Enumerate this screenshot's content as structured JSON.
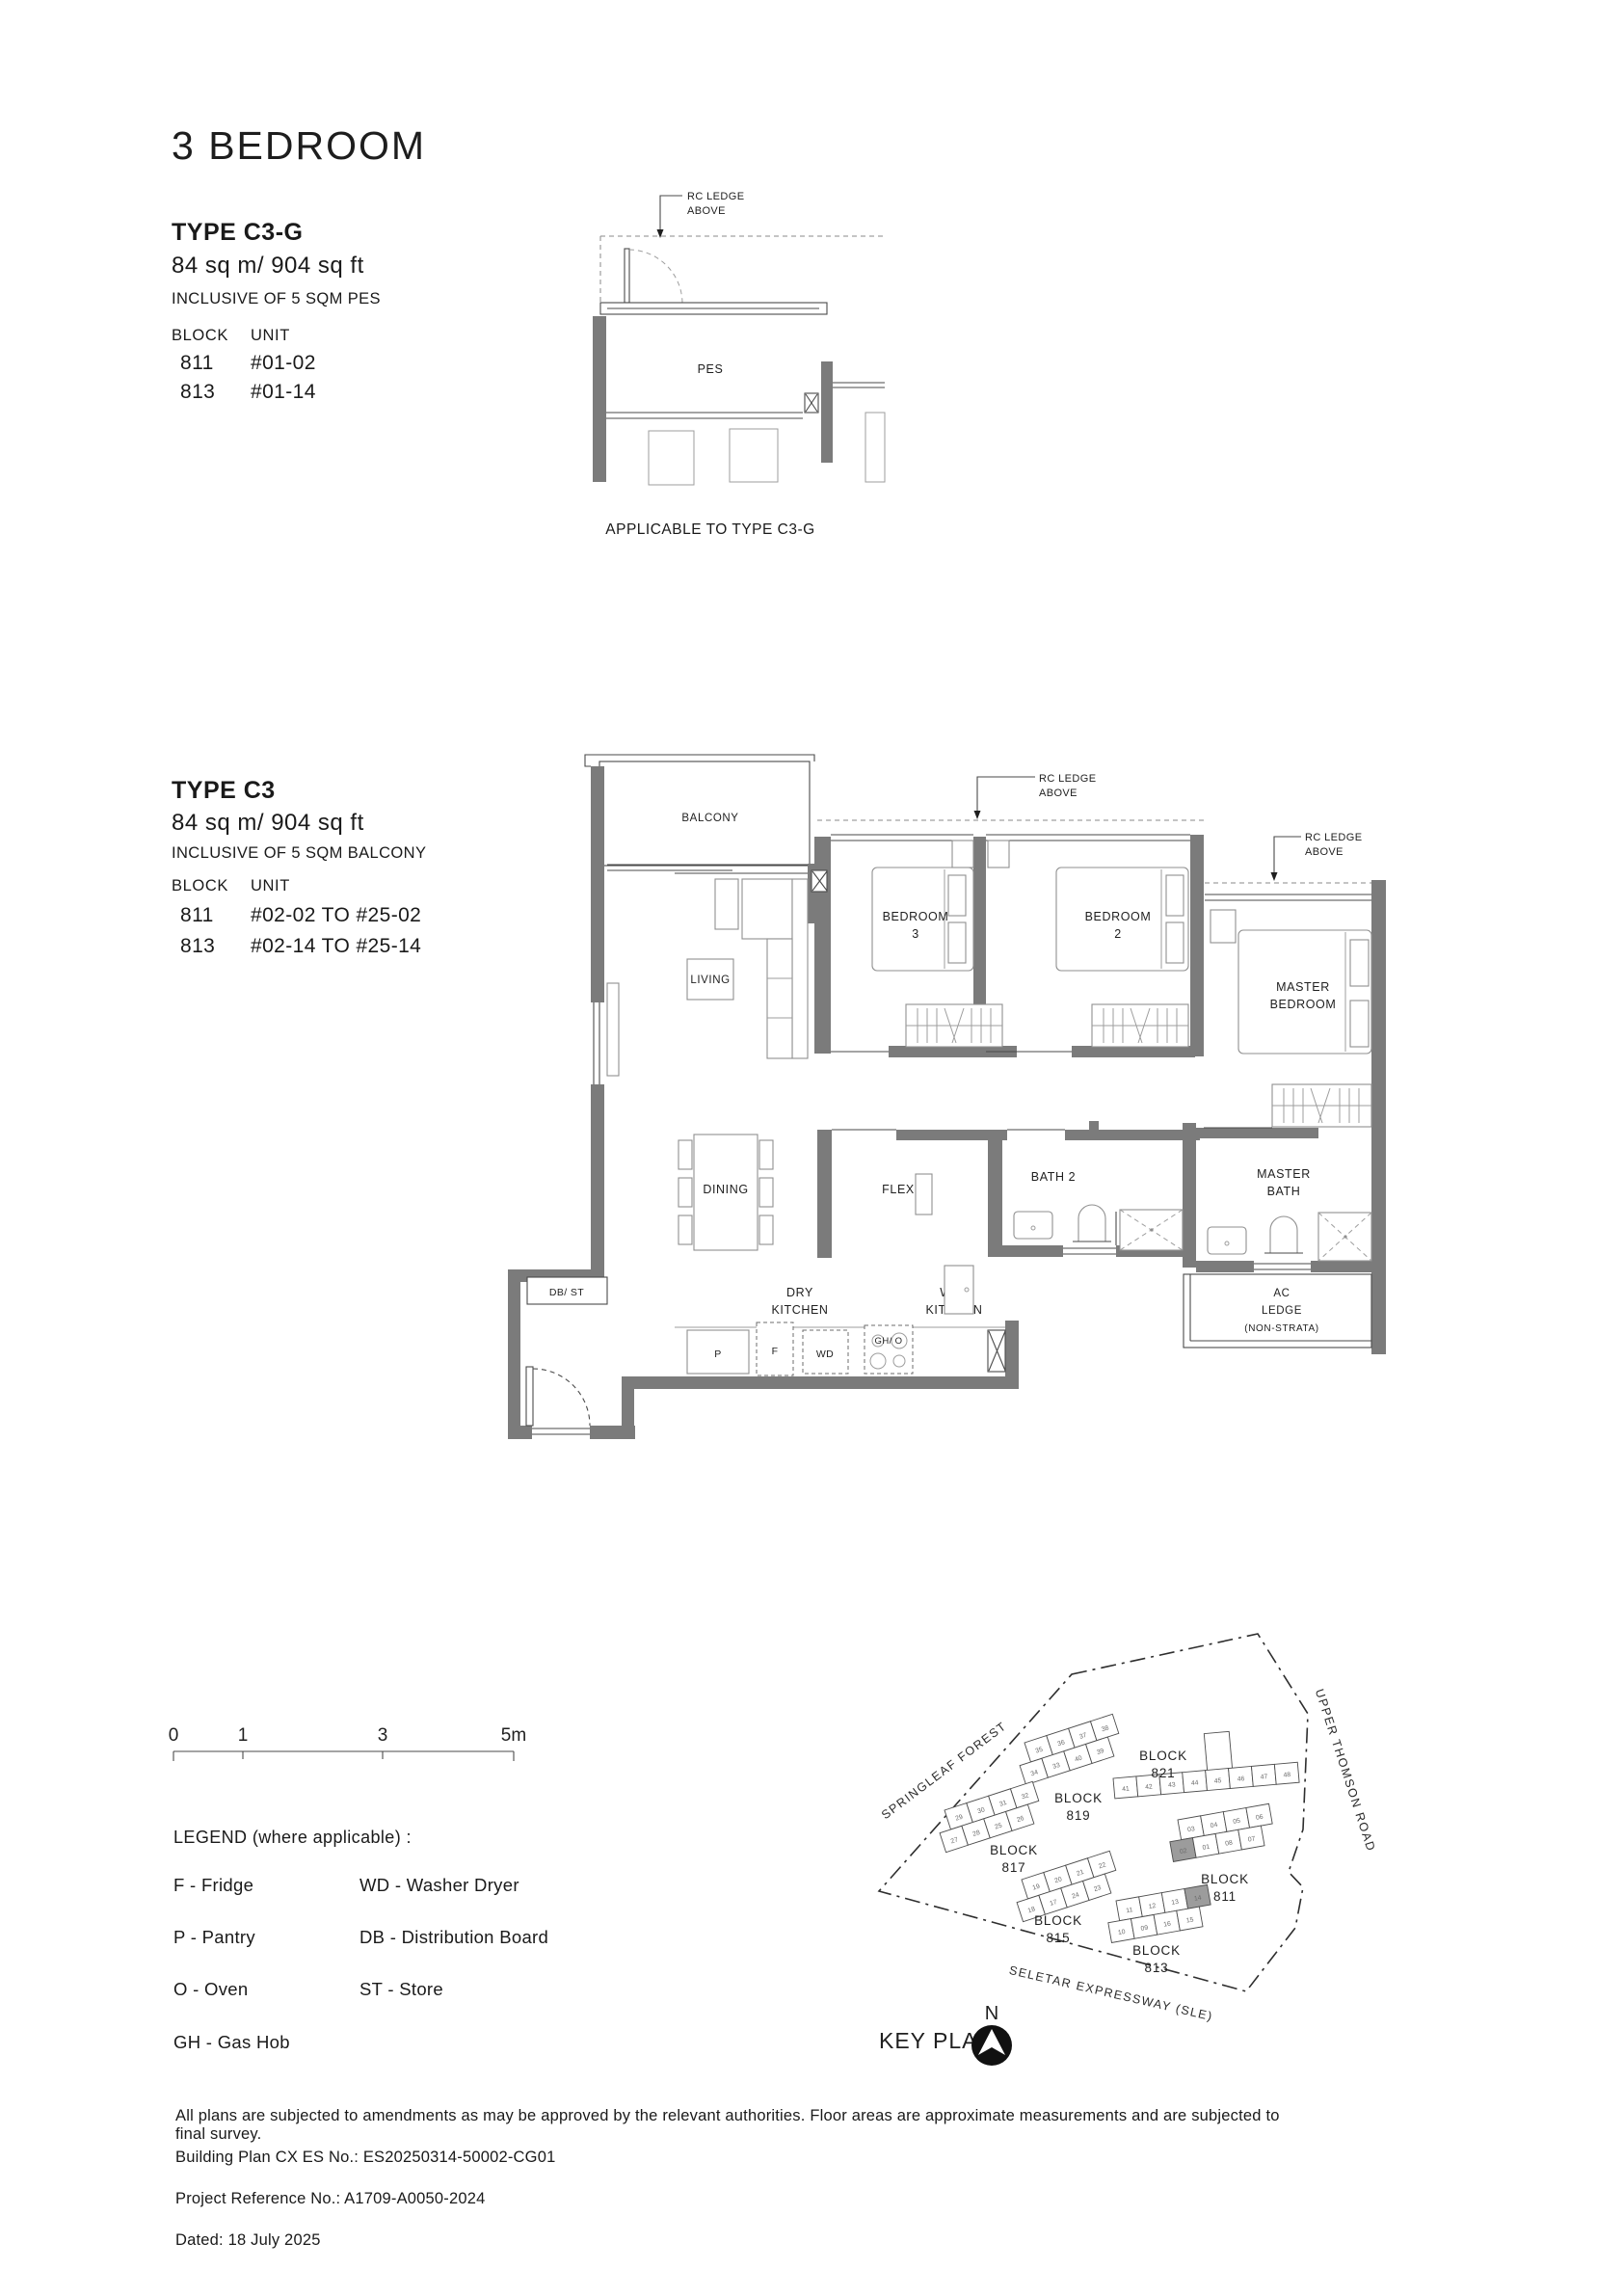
{
  "page_title": "3 BEDROOM",
  "type_c3g": {
    "name": "TYPE C3-G",
    "area": "84 sq m/ 904 sq ft",
    "inclusive": "INCLUSIVE OF 5 SQM PES",
    "block_header": "BLOCK",
    "unit_header": "UNIT",
    "rows": [
      {
        "block": "811",
        "unit": "#01-02"
      },
      {
        "block": "813",
        "unit": "#01-14"
      }
    ],
    "caption": "APPLICABLE TO TYPE C3-G"
  },
  "type_c3": {
    "name": "TYPE C3",
    "area": "84 sq m/ 904 sq ft",
    "inclusive": "INCLUSIVE OF 5 SQM BALCONY",
    "block_header": "BLOCK",
    "unit_header": "UNIT",
    "rows": [
      {
        "block": "811",
        "unit": "#02-02 TO #25-02"
      },
      {
        "block": "813",
        "unit": "#02-14 TO #25-14"
      }
    ]
  },
  "plan": {
    "rc_ledge_1": "RC LEDGE",
    "rc_ledge_2": "ABOVE",
    "pes": "PES",
    "balcony": "BALCONY",
    "living": "LIVING",
    "bedroom3_1": "BEDROOM",
    "bedroom3_2": "3",
    "bedroom2_1": "BEDROOM",
    "bedroom2_2": "2",
    "master_1": "MASTER",
    "master_2": "BEDROOM",
    "dining": "DINING",
    "flex": "FLEX",
    "bath2": "BATH 2",
    "masterbath_1": "MASTER",
    "masterbath_2": "BATH",
    "dry_1": "DRY",
    "dry_2": "KITCHEN",
    "wet_1": "WET",
    "wet_2": "KITCHEN",
    "db_st": "DB/ ST",
    "p": "P",
    "f": "F",
    "wd": "WD",
    "gho": "GH/ O",
    "ac_1": "AC",
    "ac_2": "LEDGE",
    "ac_3": "(NON-STRATA)"
  },
  "scale": {
    "t0": "0",
    "t1": "1",
    "t3": "3",
    "t5": "5m"
  },
  "legend": {
    "heading": "LEGEND (where applicable) :",
    "col1": [
      "F - Fridge",
      "P - Pantry",
      "O - Oven",
      "GH - Gas Hob"
    ],
    "col2": [
      "WD - Washer Dryer",
      "DB - Distribution Board",
      "ST - Store"
    ]
  },
  "keyplan": {
    "label": "KEY PLAN",
    "north": "N",
    "roads": {
      "left": "SPRINGLEAF FOREST",
      "right": "UPPER THOMSON ROAD",
      "bottom": "SELETAR EXPRESSWAY (SLE)"
    },
    "blocks": {
      "b819": {
        "l1": "BLOCK",
        "l2": "819",
        "top": [
          "35",
          "36",
          "37",
          "38"
        ],
        "bottom": [
          "34",
          "33",
          "40",
          "39"
        ]
      },
      "b821": {
        "l1": "BLOCK",
        "l2": "821",
        "row": [
          "41",
          "42",
          "43",
          "44",
          "45",
          "46",
          "47",
          "48"
        ]
      },
      "b817": {
        "l1": "BLOCK",
        "l2": "817",
        "top": [
          "29",
          "30",
          "31",
          "32"
        ],
        "bottom": [
          "27",
          "28",
          "25",
          "26"
        ]
      },
      "b815": {
        "l1": "BLOCK",
        "l2": "815",
        "top": [
          "19",
          "20",
          "21",
          "22"
        ],
        "bottom": [
          "18",
          "17",
          "24",
          "23"
        ]
      },
      "b811": {
        "l1": "BLOCK",
        "l2": "811",
        "top": [
          "03",
          "04",
          "05",
          "06"
        ],
        "bottom": [
          {
            "n": "02",
            "hl": true
          },
          "01",
          "08",
          "07"
        ]
      },
      "b813": {
        "l1": "BLOCK",
        "l2": "813",
        "top": [
          "11",
          "12",
          "13",
          {
            "n": "14",
            "hl": true
          }
        ],
        "bottom": [
          "10",
          "09",
          "16",
          "15"
        ]
      }
    }
  },
  "footer": {
    "line1": "All plans are subjected to amendments as may be approved by the relevant authorities. Floor areas are approximate measurements and are subjected to final survey.",
    "line2": "Building Plan CX ES No.: ES20250314-50002-CG01",
    "line3": "Project Reference No.: A1709-A0050-2024",
    "line4": "Dated: 18 July 2025"
  }
}
